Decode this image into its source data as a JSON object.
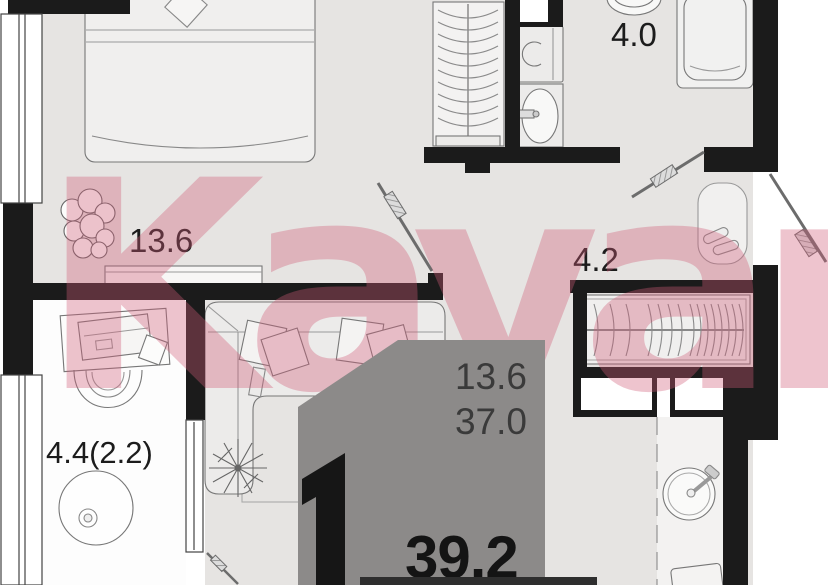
{
  "title": "1-room apartment floor plan",
  "watermark": {
    "text": "Kayan",
    "color": "#d05c76"
  },
  "room_labels": {
    "bedroom": "13.6",
    "bathroom": "4.0",
    "hallway": "4.2",
    "balcony": "4.4(2.2)"
  },
  "area_badge": {
    "rooms_count": "1",
    "living_area": "13.6",
    "floor_area": "37.0",
    "total_area": "39.2",
    "bg_color": "#8c8a89"
  },
  "colors": {
    "wall": "#1b1b1b",
    "floor": "#e6e4e2",
    "balcony_floor": "#fdfdfd",
    "furniture_line": "#777777"
  }
}
